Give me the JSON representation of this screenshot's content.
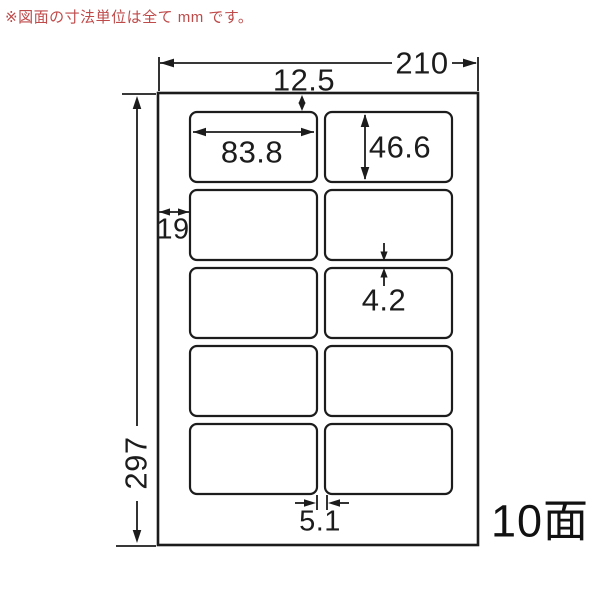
{
  "note": "※図面の寸法単位は全て mm です。",
  "colors": {
    "note_text": "#bf4a4a",
    "line": "#1c1c1c",
    "paper_fill": "#ffffff"
  },
  "sheet": {
    "faces_label": "10面",
    "grid": {
      "rows": 5,
      "cols": 2
    }
  },
  "dimensions": {
    "paper_width_mm": "210",
    "paper_height_mm": "297",
    "top_margin_mm": "12.5",
    "left_margin_mm": "19",
    "label_width_mm": "83.8",
    "label_height_mm": "46.6",
    "row_gap_mm": "4.2",
    "col_gap_mm": "5.1"
  }
}
